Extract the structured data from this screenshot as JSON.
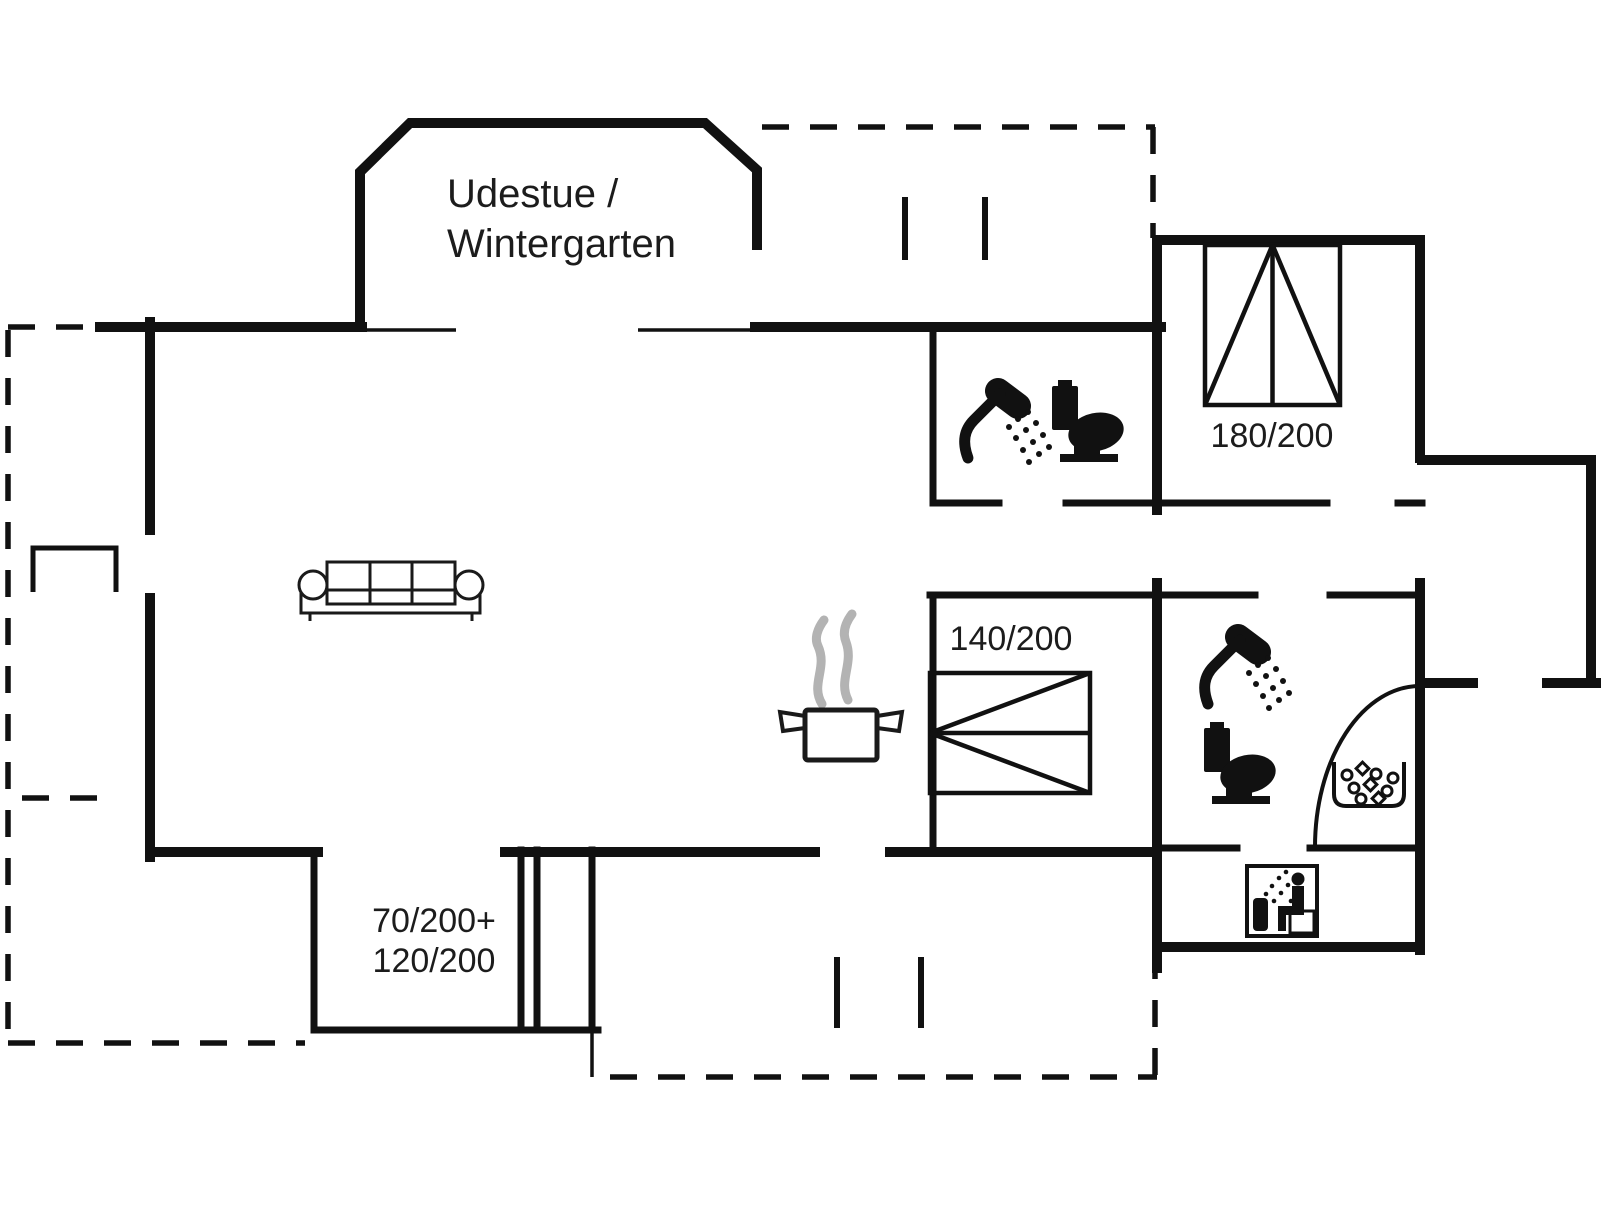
{
  "plan": {
    "title": "Holiday house floor plan",
    "labels": {
      "conservatory_line1": "Udestue /",
      "conservatory_line2": "Wintergarten",
      "bed_double": "180/200",
      "bed_small": "140/200",
      "bed_bunk_line1": "70/200+",
      "bed_bunk_line2": "120/200"
    },
    "colors": {
      "wall": "#111111",
      "furniture": "#1a1a1a",
      "steam": "#b3b3b3",
      "background": "#ffffff"
    },
    "icons": {
      "sofa": "sofa-icon",
      "cooking_pot": "cooking-pot-icon",
      "double_bed": "double-bed-icon",
      "single_bed": "single-bed-icon",
      "shower": "shower-icon",
      "toilet": "toilet-icon",
      "whirlpool": "whirlpool-bubbles-icon",
      "sauna": "sauna-person-icon",
      "door_swing": "door-swing-arc"
    }
  }
}
